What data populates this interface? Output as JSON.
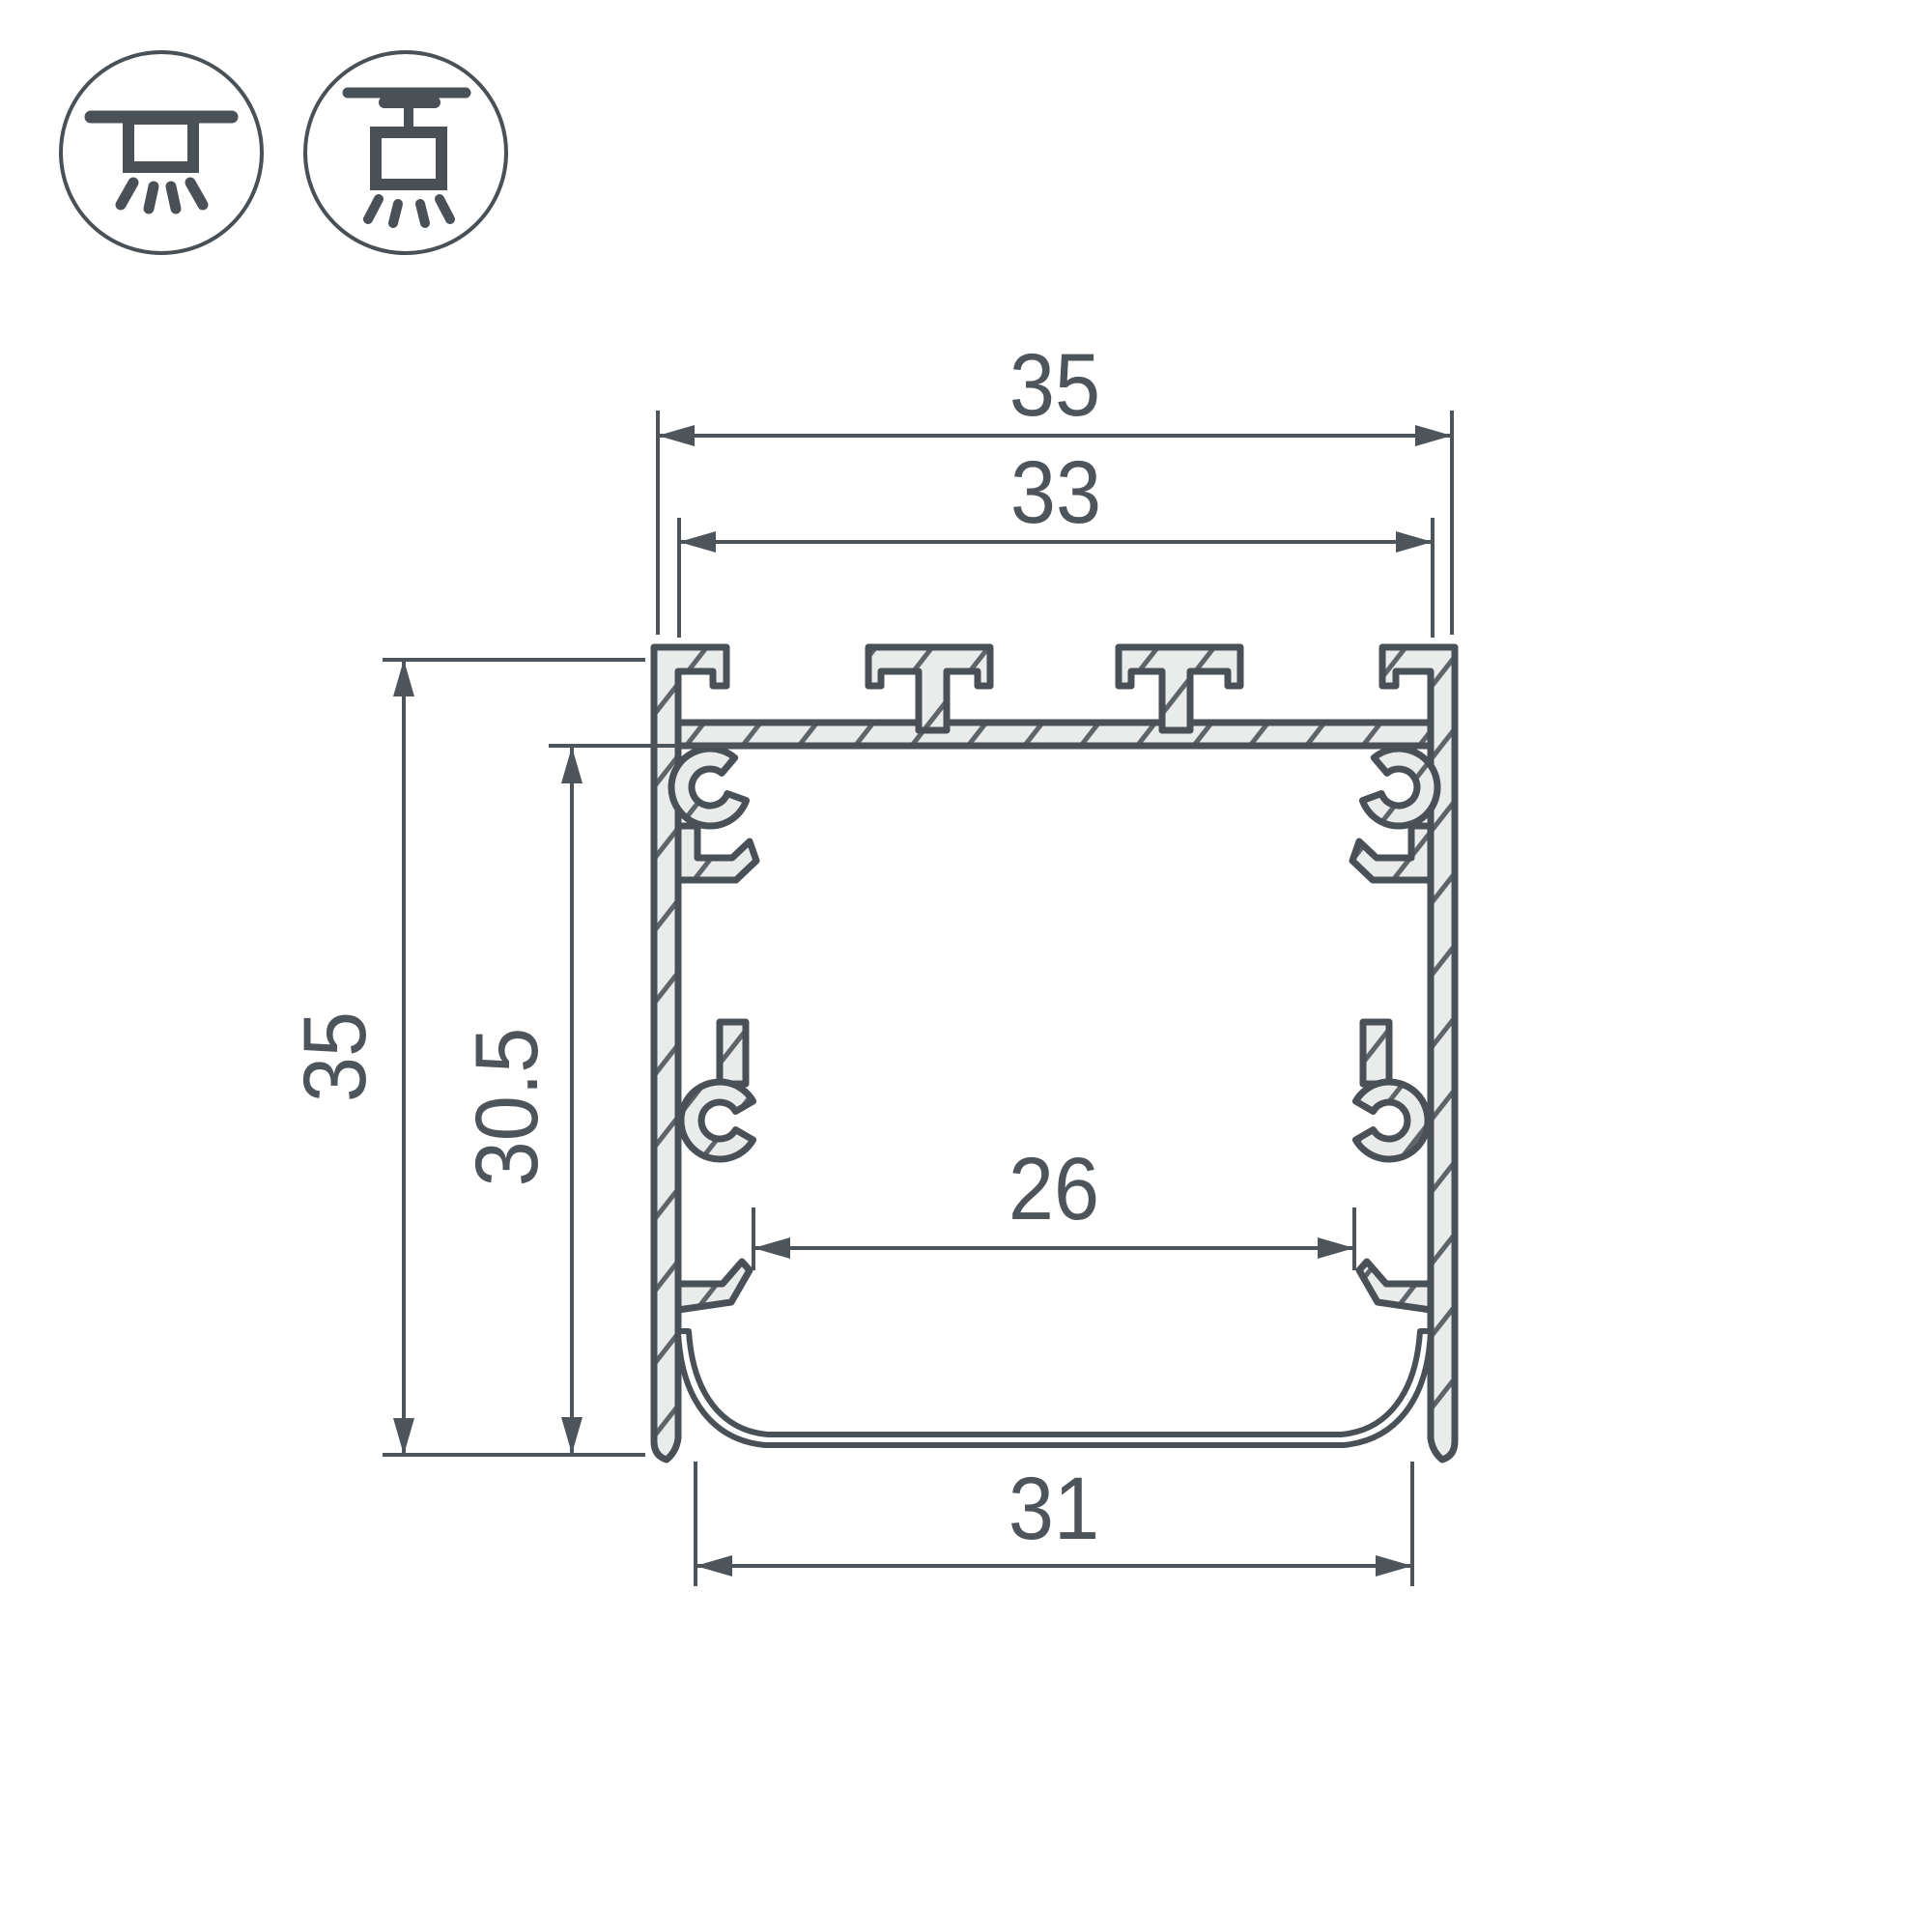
{
  "drawing": {
    "type": "profile-cross-section-dimension-drawing",
    "units_shown": "mm (implied, unlabeled)",
    "colors": {
      "outline": "#4a5156",
      "metal_fill": "#eaecec",
      "hatch_line": "#5d6569",
      "dimension_line": "#4d555b",
      "background": "#ffffff"
    },
    "dimensions": {
      "overall_width": "35",
      "slot_span_width": "33",
      "overall_height": "35",
      "inner_height": "30.5",
      "inner_width": "26",
      "bottom_opening_width": "31"
    },
    "icons": {
      "surface_mount_label": "surface-mount-luminaire-icon",
      "pendant_mount_label": "pendant-suspended-luminaire-icon"
    },
    "features": [
      "top T-slots with four tabs",
      "hatched extruded aluminium walls",
      "screw boss channels on inner walls",
      "snap-in hooks for diffuser",
      "curved bottom diffuser lens"
    ]
  }
}
